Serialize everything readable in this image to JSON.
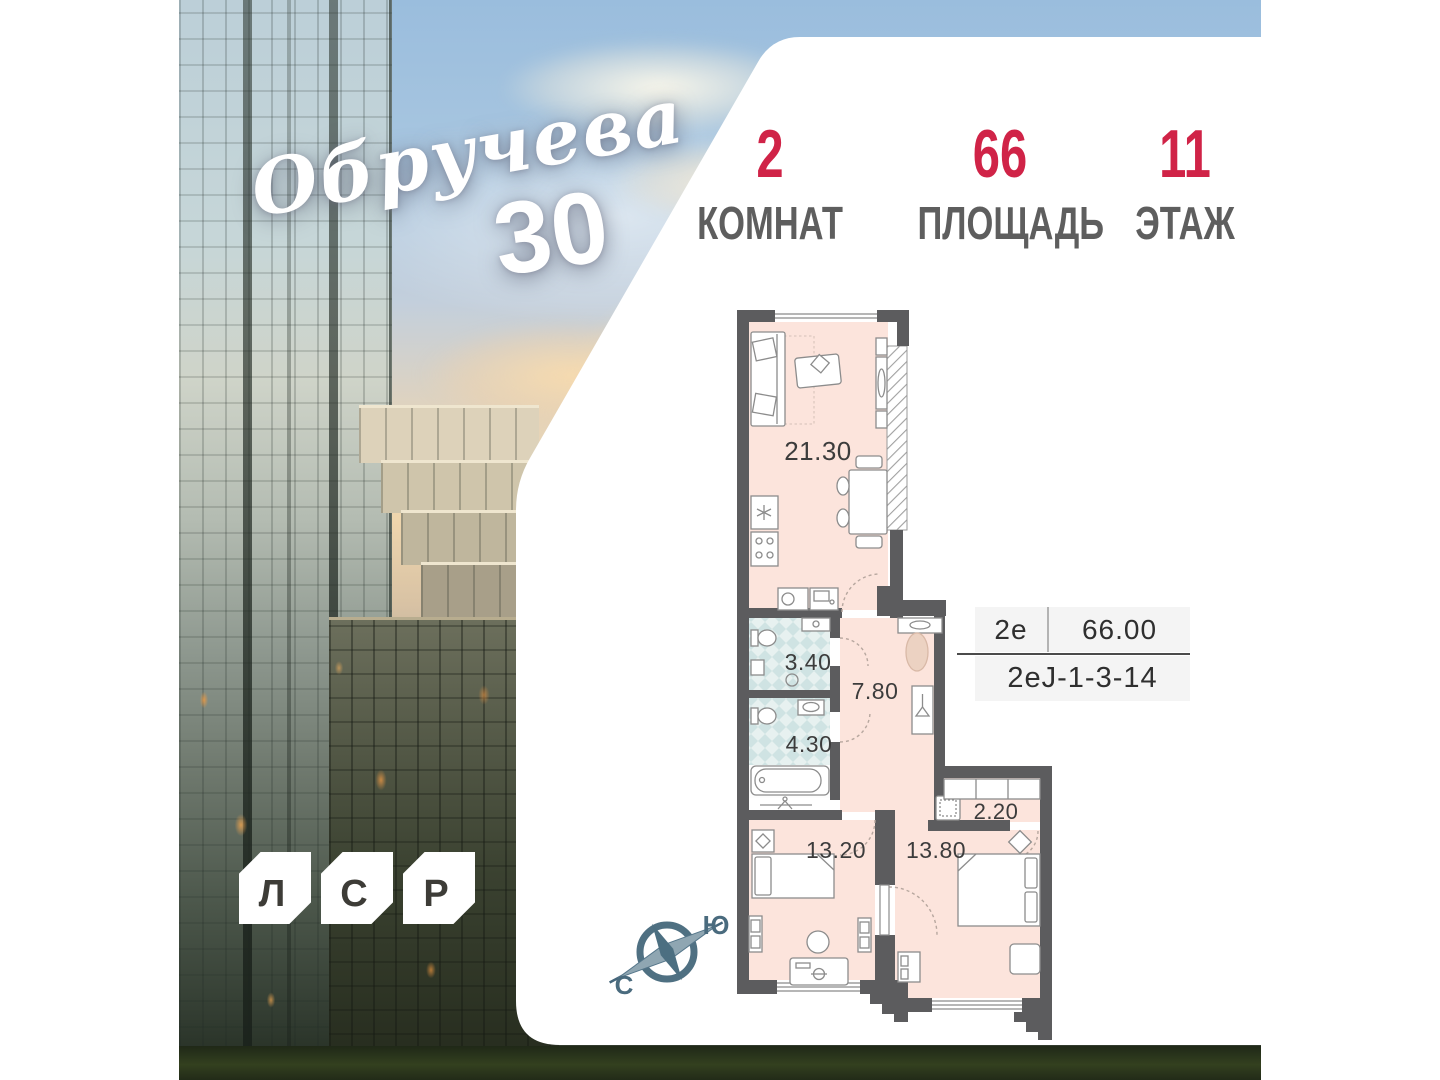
{
  "brand": {
    "name": "Обручева",
    "number": "30",
    "letters": [
      "Л",
      "С",
      "Р"
    ]
  },
  "stats": [
    {
      "value": "2",
      "label": "КОМНАТ"
    },
    {
      "value": "66",
      "label": "ПЛОЩАДЬ"
    },
    {
      "value": "11",
      "label": "ЭТАЖ"
    }
  ],
  "info": {
    "type": "2е",
    "area": "66.00",
    "code": "2еJ-1-3-14"
  },
  "compass": {
    "north": "С",
    "south": "Ю"
  },
  "plan": {
    "rooms": [
      {
        "id": "living-kitchen",
        "area": "21.30"
      },
      {
        "id": "bathroom-small",
        "area": "3.40"
      },
      {
        "id": "hallway",
        "area": "7.80"
      },
      {
        "id": "bathroom",
        "area": "4.30"
      },
      {
        "id": "bedroom-1",
        "area": "13.20"
      },
      {
        "id": "bedroom-2",
        "area": "13.80"
      },
      {
        "id": "storage",
        "area": "2.20"
      }
    ]
  },
  "colors": {
    "accent_red": "#d02347",
    "wall": "#5c5c5e",
    "floor": "#fce4dc",
    "tile": "#cfe3e3",
    "label_gray": "#5e5e5e"
  }
}
